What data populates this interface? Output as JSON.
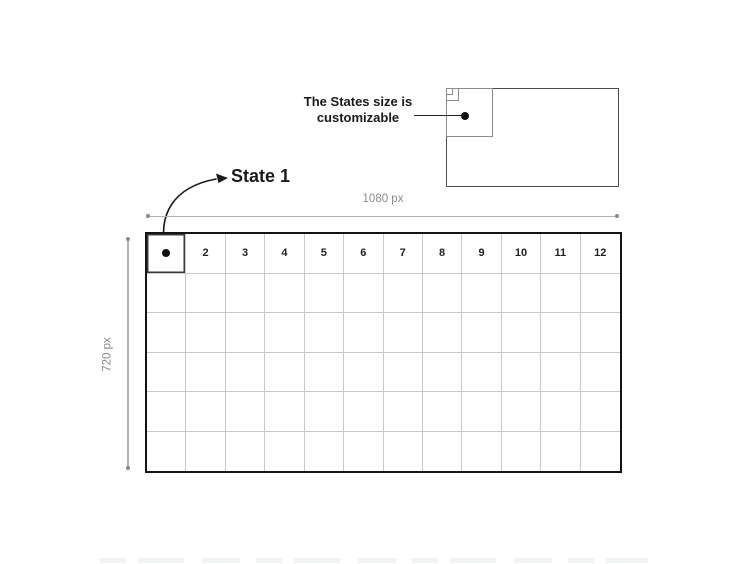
{
  "page": {
    "background": "#ffffff"
  },
  "mini_diagram": {
    "note_lines": [
      "The States size is",
      "customizable"
    ],
    "outer_border_color": "#4d4d4d",
    "inner_border_color": "#8c8c8c",
    "dot_color": "#111111"
  },
  "state_annotation": {
    "label": "State 1"
  },
  "dimension_labels": {
    "width": "1080 px",
    "height": "720 px",
    "line_color": "#b2b2b2",
    "text_color": "#8a8a8a"
  },
  "grid": {
    "columns": 12,
    "rows": 6,
    "header_numbers": [
      "2",
      "3",
      "4",
      "5",
      "6",
      "7",
      "8",
      "9",
      "10",
      "11",
      "12"
    ],
    "outer_border_color": "#141414",
    "inner_line_color": "#c9c9c9",
    "state1_cell_border_color": "#3a3a3a",
    "dot_color": "#111111",
    "number_color": "#222222"
  }
}
